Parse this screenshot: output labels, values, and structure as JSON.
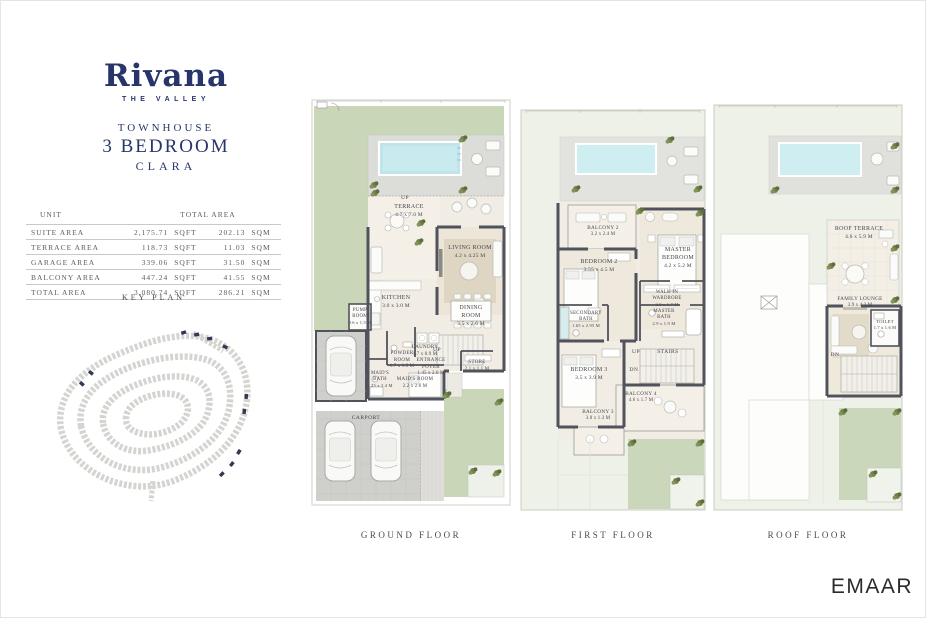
{
  "brand": {
    "name": "Rivana",
    "tagline": "THE VALLEY"
  },
  "unit": {
    "type": "TOWNHOUSE",
    "bedrooms": "3 BEDROOM",
    "model": "CLARA"
  },
  "area_table": {
    "header": {
      "unit": "UNIT",
      "total_area": "TOTAL AREA"
    },
    "rows": [
      {
        "label": "SUITE AREA",
        "sqft": "2,175.71",
        "sqft_unit": "SQFT",
        "sqm": "202.13",
        "sqm_unit": "SQM"
      },
      {
        "label": "TERRACE AREA",
        "sqft": "118.73",
        "sqft_unit": "SQFT",
        "sqm": "11.03",
        "sqm_unit": "SQM"
      },
      {
        "label": "GARAGE AREA",
        "sqft": "339.06",
        "sqft_unit": "SQFT",
        "sqm": "31.50",
        "sqm_unit": "SQM"
      },
      {
        "label": "BALCONY AREA",
        "sqft": "447.24",
        "sqft_unit": "SQFT",
        "sqm": "41.55",
        "sqm_unit": "SQM"
      },
      {
        "label": "TOTAL AREA",
        "sqft": "3,080.74",
        "sqft_unit": "SQFT",
        "sqm": "286.21",
        "sqm_unit": "SQM"
      }
    ]
  },
  "key_plan": {
    "title": "KEY PLAN"
  },
  "floors": {
    "ground": {
      "label": "GROUND FLOOR",
      "rooms": {
        "terrace": {
          "name": "TERRACE",
          "dims": "4.7 x 7.0 M"
        },
        "living": {
          "name": "LIVING ROOM",
          "dims": "4.2 x 4.25 M"
        },
        "kitchen": {
          "name": "KITCHEN",
          "dims": "3.0 x 3.0 M"
        },
        "dining": {
          "name": "DINING ROOM",
          "dims": "3.5 x 2.6 M"
        },
        "pump": {
          "name": "PUMP ROOM",
          "dims": "0.6 x 1.5 M"
        },
        "laundry": {
          "name": "LAUNDRY",
          "dims": "1.7 x 0.9 M"
        },
        "powder": {
          "name": "POWDER ROOM",
          "dims": "1.7 x 1.9 M"
        },
        "foyer": {
          "name": "ENTRANCE FOYER",
          "dims": "1.45 x 2.0 M"
        },
        "store": {
          "name": "STORE",
          "dims": "2.1 x 1.1 M"
        },
        "maids_bath": {
          "name": "MAID'S BATH",
          "dims": "1.25 x 2.4 M"
        },
        "maids_room": {
          "name": "MAID'S ROOM",
          "dims": "2.2 x 2.6 M"
        },
        "carport": {
          "name": "CARPORT"
        },
        "up_terrace": "UP",
        "up_stairs": "UP"
      }
    },
    "first": {
      "label": "FIRST FLOOR",
      "rooms": {
        "balcony2": {
          "name": "BALCONY 2",
          "dims": "3.2 x 2.4 M"
        },
        "bedroom2": {
          "name": "BEDROOM 2",
          "dims": "3.55 x 4.5 M"
        },
        "master_bedroom": {
          "name": "MASTER\nBEDROOM",
          "dims": "4.2 x 5.2 M"
        },
        "wardrobe": {
          "name": "WALK IN\nWARDROBE",
          "dims": "2.0 x 1.7 M"
        },
        "master_bath": {
          "name": "MASTER\nBATH",
          "dims": "2.9 x 1.9 M"
        },
        "secondary_bath": {
          "name": "SECONDARY\nBATH",
          "dims": "1.65 x 2.95 M"
        },
        "bedroom3": {
          "name": "BEDROOM 3",
          "dims": "3.5 x 3.9 M"
        },
        "balcony4": {
          "name": "BALCONY 4",
          "dims": "4.6 x 1.7 M"
        },
        "balcony3": {
          "name": "BALCONY 3",
          "dims": "3.0 x 1.3 M"
        },
        "stairs": "STAIRS",
        "up": "UP",
        "dn": "DN"
      }
    },
    "roof": {
      "label": "ROOF FLOOR",
      "rooms": {
        "roof_terrace": {
          "name": "ROOF TERRACE",
          "dims": "4.6 x 5.9 M"
        },
        "family_lounge": {
          "name": "FAMILY LOUNGE",
          "dims": "3.9 x 4.2 M"
        },
        "toilet": {
          "name": "TOILET",
          "dims": "1.7 x 1.6 M"
        },
        "dn": "DN"
      }
    }
  },
  "footer": {
    "logo": "EMAAR"
  },
  "colors": {
    "navy": "#27356b",
    "garden_green": "#c9d6b8",
    "pale_green": "#edf1e7",
    "pool_blue": "#bfe5eb",
    "wall": "#51525b",
    "deck": "#dcdcd9"
  }
}
